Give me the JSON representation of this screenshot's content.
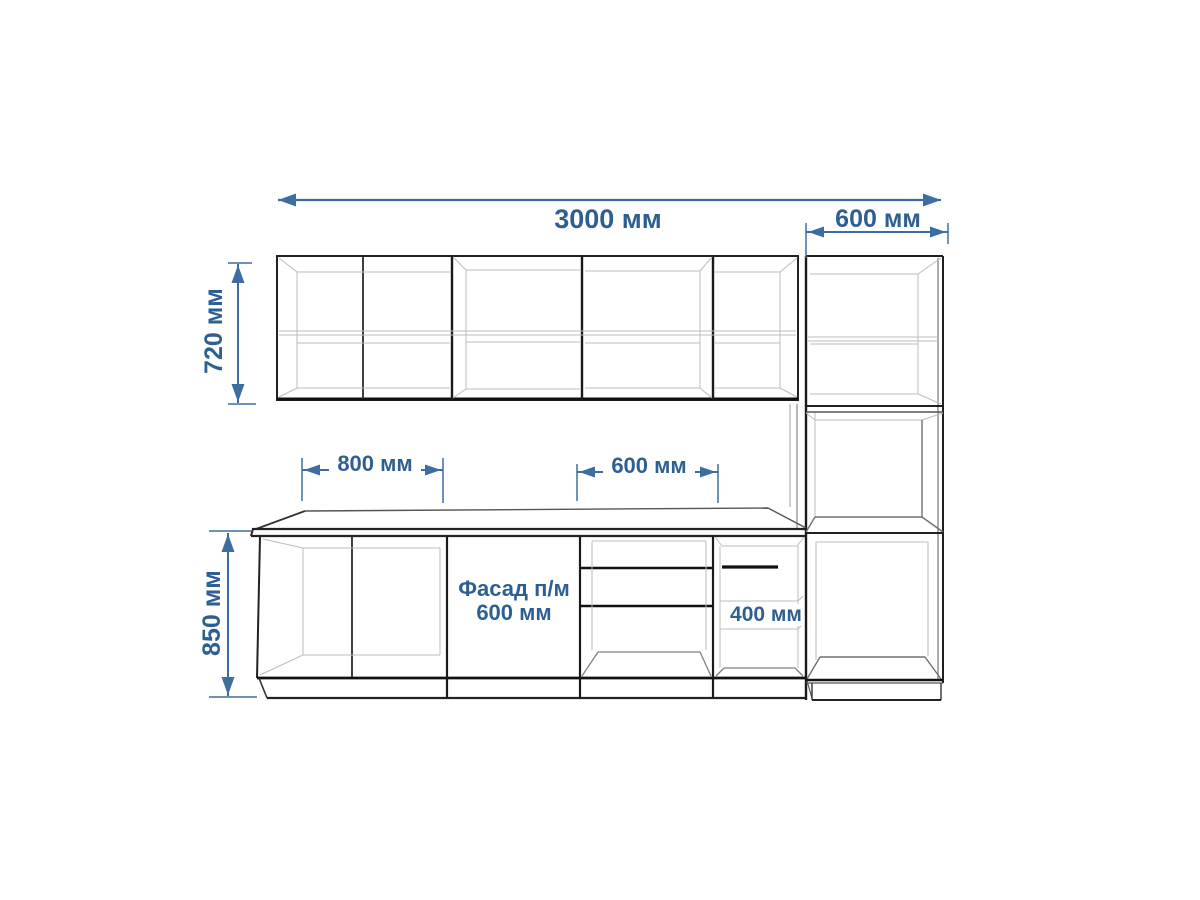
{
  "labels": {
    "total_width": "3000 мм",
    "tall_cabinet_width": "600 мм",
    "wall_cabinet_height": "720 мм",
    "base_unit_800": "800 мм",
    "drawer_unit_600": "600 мм",
    "base_height": "850 мм",
    "shelf_unit_400": "400 мм",
    "facade_line1": "Фасад п/м",
    "facade_line2": "600 мм"
  },
  "colors": {
    "dimension_text": "#2d5f92",
    "dimension_line": "#3d6da1",
    "outline_dark": "#1f1f1f",
    "outline_heavy": "#111111",
    "interior_light": "#bcbcbc",
    "interior_medium": "#808080",
    "background": "#ffffff"
  }
}
